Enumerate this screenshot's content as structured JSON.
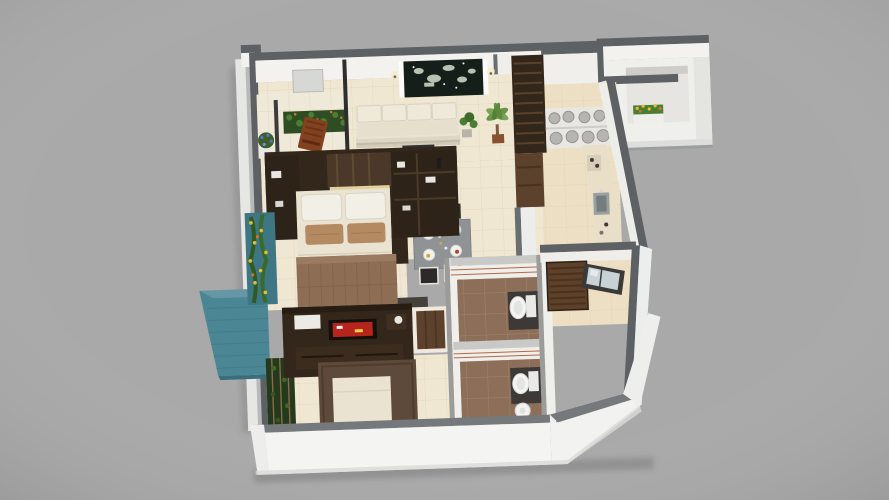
{
  "meta": {
    "kind": "3d-isometric-floorplan-render",
    "view": "top-down-oblique",
    "visible_text": "none"
  },
  "palette": {
    "background": "#a9a9a9",
    "wall_top": "#5d6164",
    "wall_top_light": "#83878a",
    "wall_face": "#f3f2ef",
    "wall_face_shade": "#e4e4e1",
    "floor_tile": "#f0e7d3",
    "floor_warm": "#ecdfc4",
    "tile_line": "#dccfb4",
    "wood_dark": "#33261a",
    "wood_mid": "#5c412c",
    "sofa_cream": "#e9e3d4",
    "bed_sheet": "#ebe3d2",
    "blanket_brown": "#8d6e55",
    "pillow_tan": "#b38a62",
    "teal": "#4b8694",
    "teal_panel": "#3e7684",
    "plant_dark": "#2f4d22",
    "plant_green": "#4c7d33",
    "flower_yellow": "#e7bd2e",
    "flower_orange": "#d8722a",
    "bath_floor": "#8d6f59",
    "stripe_red": "#b06a4a",
    "porcelain": "#f4f4f2",
    "table_gray": "#8f9396",
    "chair_dark": "#2b2a28",
    "granite": "#2e3133",
    "art_dark": "#151e18",
    "art_light": "#d6decf",
    "tv_red": "#b5251c",
    "glass": "#c8d2d4",
    "frame_dark": "#3a3a38",
    "canister_gray": "#b7b5b2",
    "counter_sand": "#e9dfc9"
  },
  "scene": {
    "rooms": [
      {
        "name": "living-room",
        "objects": [
          "sofa",
          "wall-art",
          "wall-sconces",
          "potted-plants",
          "switch-board"
        ]
      },
      {
        "name": "balcony",
        "objects": [
          "rocking-chair",
          "hedge-planter",
          "blue-flower-pot",
          "railing"
        ]
      },
      {
        "name": "kitchen",
        "objects": [
          "tall-cabinet",
          "canister-shelf",
          "counter-with-sink",
          "hob"
        ]
      },
      {
        "name": "dining-area",
        "objects": [
          "dining-table",
          "four-chairs",
          "place-settings",
          "crockery-unit",
          "twig-vase"
        ]
      },
      {
        "name": "master-bedroom",
        "objects": [
          "double-bed",
          "headboard-wall",
          "bedside-shelves",
          "dark-rug"
        ]
      },
      {
        "name": "terrace",
        "objects": [
          "teal-water-feature",
          "vertical-garden"
        ]
      },
      {
        "name": "second-bedroom",
        "objects": [
          "bed",
          "wardrobe-tv-unit",
          "vertical-garden",
          "wooden-door"
        ]
      },
      {
        "name": "bathroom-1",
        "objects": [
          "toilet"
        ]
      },
      {
        "name": "bathroom-2",
        "objects": [
          "toilet",
          "wash-basin"
        ]
      },
      {
        "name": "passage",
        "objects": [
          "slatted-door",
          "window"
        ]
      },
      {
        "name": "utility-balcony",
        "objects": [
          "flower-box"
        ]
      }
    ]
  }
}
